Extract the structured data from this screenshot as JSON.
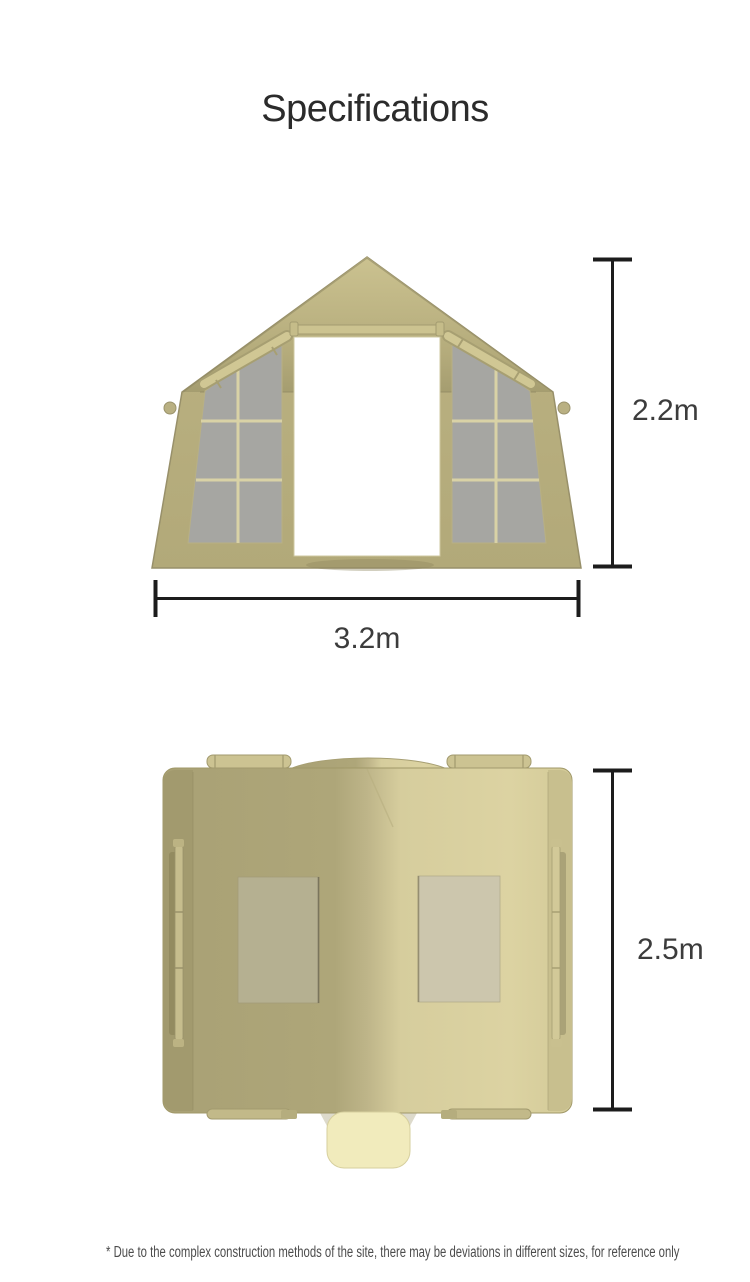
{
  "header": {
    "title": "Specifications"
  },
  "front_view": {
    "height_label": "2.2m",
    "width_label": "3.2m"
  },
  "top_view": {
    "depth_label": "2.5m"
  },
  "footer": {
    "note": "* Due to the complex construction methods of the site, there may be deviations in different sizes, for reference only"
  },
  "colors": {
    "background": "#ffffff",
    "fabric": "#b5ac7c",
    "fabric_light": "#d9d0a0",
    "fabric_dark": "#a49c6f",
    "window_mesh": "#a6a6a2",
    "window_grid": "#d9d2a6",
    "door_fill": "#ffffff",
    "door_flap_tab": "#f1ebbc",
    "dimension_line": "#1c1c1c",
    "dimension_text": "#3c3c3c",
    "title_text": "#2b2b2b",
    "note_text": "#4c4c4c"
  }
}
